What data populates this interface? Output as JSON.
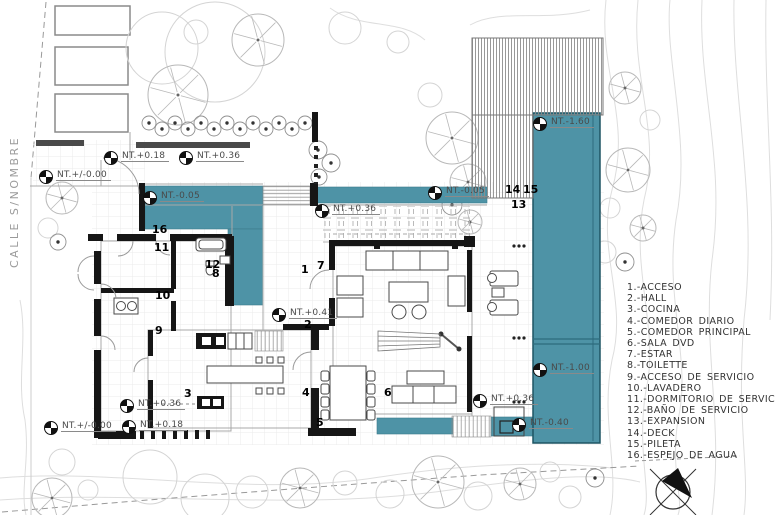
{
  "title": "house-floor-plan",
  "colors": {
    "water": "#4E93A6",
    "wall": "#161616",
    "annotation": "#4a4a4a"
  },
  "street": {
    "label": "CALLE S/NOMBRE"
  },
  "legend": {
    "items": [
      "1.-ACCESO",
      "2.-HALL",
      "3.-COCINA",
      "4.-COMEDOR DIARIO",
      "5.-COMEDOR PRINCIPAL",
      "6.-SALA DVD",
      "7.-ESTAR",
      "8.-TOILETTE",
      "9.-ACCESO DE SERVICIO",
      "10.-LAVADERO",
      "11.-DORMITORIO DE SERVICIO",
      "12.-BAÑO DE SERVICIO",
      "13.-EXPANSION",
      "14.-DECK",
      "15.-PILETA",
      "16.-ESPEJO DE AGUA"
    ]
  },
  "plan": {
    "room_numbers": [
      {
        "n": "1",
        "x": 301,
        "y": 265
      },
      {
        "n": "2",
        "x": 304,
        "y": 320
      },
      {
        "n": "3",
        "x": 184,
        "y": 389
      },
      {
        "n": "4",
        "x": 302,
        "y": 388
      },
      {
        "n": "5",
        "x": 316,
        "y": 418
      },
      {
        "n": "6",
        "x": 384,
        "y": 388
      },
      {
        "n": "7",
        "x": 317,
        "y": 261
      },
      {
        "n": "8",
        "x": 212,
        "y": 269
      },
      {
        "n": "9",
        "x": 155,
        "y": 326
      },
      {
        "n": "10",
        "x": 155,
        "y": 291
      },
      {
        "n": "11",
        "x": 154,
        "y": 243
      },
      {
        "n": "12",
        "x": 205,
        "y": 260
      },
      {
        "n": "13",
        "x": 511,
        "y": 200
      },
      {
        "n": "14",
        "x": 505,
        "y": 185
      },
      {
        "n": "15",
        "x": 523,
        "y": 185
      },
      {
        "n": "16",
        "x": 152,
        "y": 225
      }
    ],
    "levels": [
      {
        "t": "NT.+/-0.00",
        "x": 46,
        "y": 177
      },
      {
        "t": "NT.+0.18",
        "x": 111,
        "y": 158
      },
      {
        "t": "NT.+0.36",
        "x": 186,
        "y": 158
      },
      {
        "t": "NT.-0.05",
        "x": 150,
        "y": 198
      },
      {
        "t": "NT.+0.36",
        "x": 322,
        "y": 211
      },
      {
        "t": "NT.-0.05",
        "x": 435,
        "y": 193
      },
      {
        "t": "NT.-1.60",
        "x": 540,
        "y": 124
      },
      {
        "t": "NT.-1.00",
        "x": 540,
        "y": 370
      },
      {
        "t": "NT.+0.41",
        "x": 279,
        "y": 315
      },
      {
        "t": "NT.+0.36",
        "x": 480,
        "y": 401
      },
      {
        "t": "NT.-0.40",
        "x": 519,
        "y": 425
      },
      {
        "t": "NT.+/-0.00",
        "x": 51,
        "y": 428
      },
      {
        "t": "NT.+0.18",
        "x": 129,
        "y": 427
      },
      {
        "t": "NT.+0.36",
        "x": 127,
        "y": 406
      }
    ]
  }
}
